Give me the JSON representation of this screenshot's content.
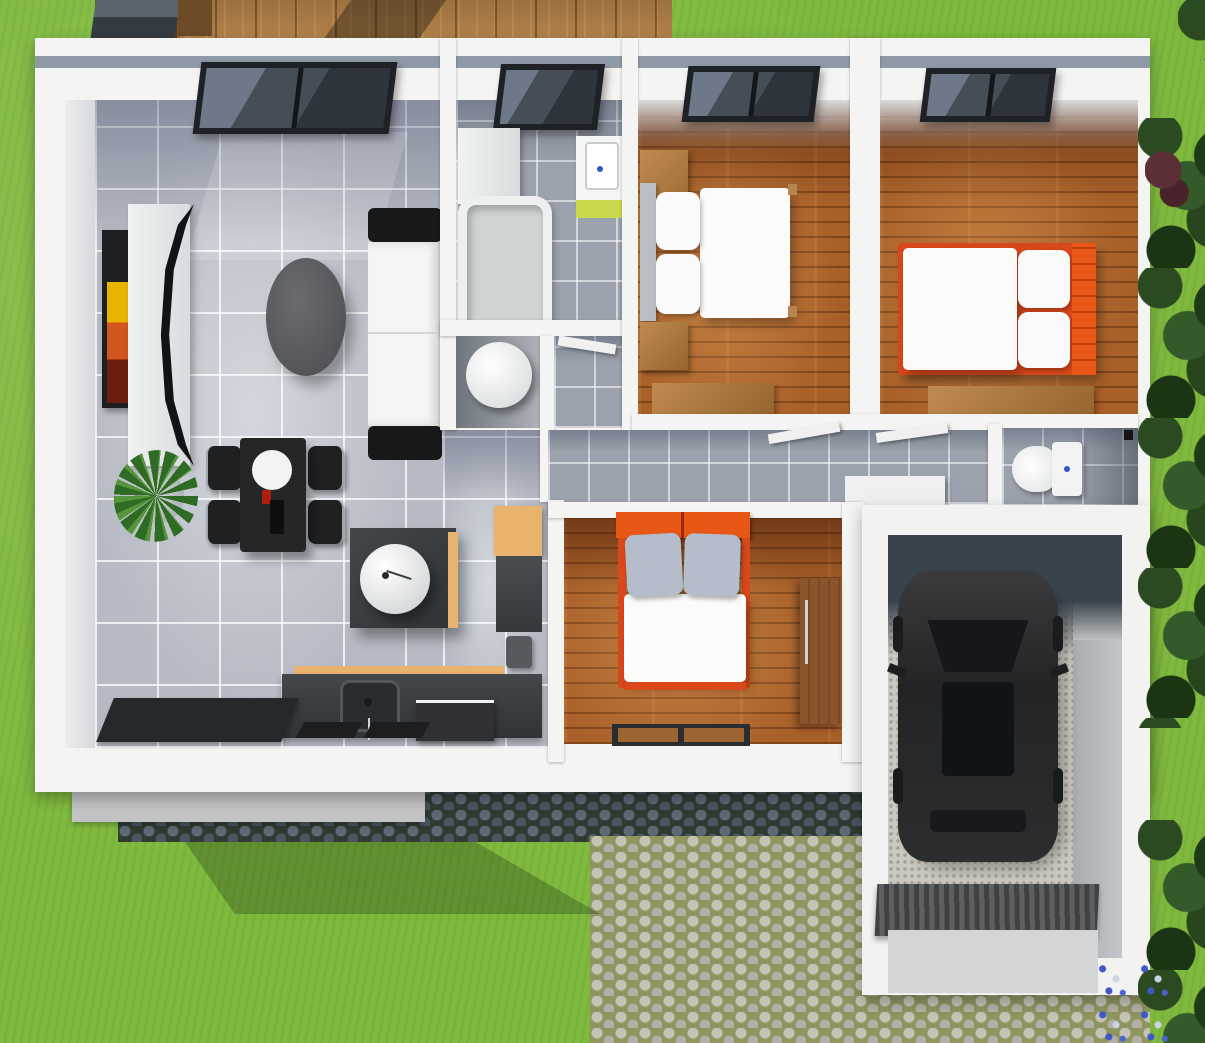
{
  "meta": {
    "title": "3D top-down floor plan render of a single-storey house with garage",
    "view": "top-down 3d architectural visualization",
    "visible_text": "none"
  },
  "exterior": {
    "lawn": "bright green grass surrounding the house",
    "deck": "horizontal wooden deck strip along the top edge",
    "barbecue_grill": "dark grill unit at deck top-left corner",
    "driveway": "cobblestone path below the house leading to the garage, dark shadow band near the wall",
    "entry_step": "gray concrete step strip below the living-room wall",
    "hedge": "dense dark trees and shrubs along the right edge with one reddish bush",
    "flower_patch": "small blue and white flowers near the garage bottom corner"
  },
  "rooms": [
    {
      "name": "living-room-kitchen",
      "floor": "large light-gray tiles",
      "window": "wide dark-framed window in top wall",
      "furniture": [
        "wall-art picture",
        "curved black tv panel",
        "white tv board",
        "oval coffee table",
        "white sofa with black armrests",
        "potted agave plant",
        "black dining table with white plate",
        "4 black dining chairs",
        "kitchen island with round white basin",
        "orange-topped tall cabinet",
        "kitchen counter with sink and faucet",
        "dishwasher box",
        "dark entrance doormat"
      ]
    },
    {
      "name": "bathroom",
      "floor": "gray tiles",
      "window": "dark skylight window",
      "furniture": [
        "white storage cabinet",
        "bathtub",
        "vanity sink with lime-green front and blue tap dot"
      ]
    },
    {
      "name": "laundry-closet",
      "floor": "shadowed gray",
      "furniture": [
        "white cylindrical washing machine (top view)"
      ]
    },
    {
      "name": "closet-nook",
      "floor": "gray tiles",
      "furniture": [
        "open door leaf"
      ]
    },
    {
      "name": "bedroom-1",
      "floor": "wooden planks",
      "window": "dark-framed window",
      "furniture": [
        "double bed, gray headboard left, two white pillows, white duvet",
        "2 wooden nightstands",
        "wooden dresser"
      ]
    },
    {
      "name": "bedroom-2",
      "floor": "wooden planks",
      "window": "dark-framed window",
      "furniture": [
        "double bed with orange frame and orange headboard on right",
        "wooden desk"
      ]
    },
    {
      "name": "hallway",
      "floor": "gray tiles",
      "furniture": [
        "two open white door leaves",
        "low white cabinet"
      ]
    },
    {
      "name": "toilet-room",
      "floor": "gray tiles",
      "furniture": [
        "white toilet with tank, blue button dot"
      ]
    },
    {
      "name": "bedroom-3",
      "floor": "wooden planks",
      "furniture": [
        "double bed, orange headboard top, two gray pillows, white duvet",
        "wooden wardrobe with silver handle",
        "dark doormat with two brown inserts"
      ]
    },
    {
      "name": "garage",
      "floor": "speckled gravel and concrete",
      "furniture": [
        "dark car seen from above with black roof glass",
        "ribbed garage door ramp"
      ]
    }
  ],
  "counts": {
    "windows": 4,
    "beds": 3,
    "dining_chairs": 4,
    "doormats": 2,
    "cars": 1
  },
  "colors": {
    "grass": "#7fba3e",
    "deck_wood": "#b5834b",
    "wall_white": "#f4f4f2",
    "roof_trim": "#8e9aa6",
    "tile_floor": "#b6bac4",
    "small_tile": "#9ba2ad",
    "wood_floor": "#a85f28",
    "bed_accent_orange": "#d8481a",
    "headboard_orange": "#e85716",
    "lime_vanity": "#c9d84d",
    "counter_wood_top": "#e9b36d",
    "dark_furniture": "#3a3d40",
    "car_body": "#2c2d2f",
    "cobble_light_stone": "#c6c2b8",
    "cobble_dark_stone": "#5d6875",
    "foliage_dark": "#27461d",
    "garage_shadow": "#39434d",
    "tap_blue": "#2b55c8"
  }
}
